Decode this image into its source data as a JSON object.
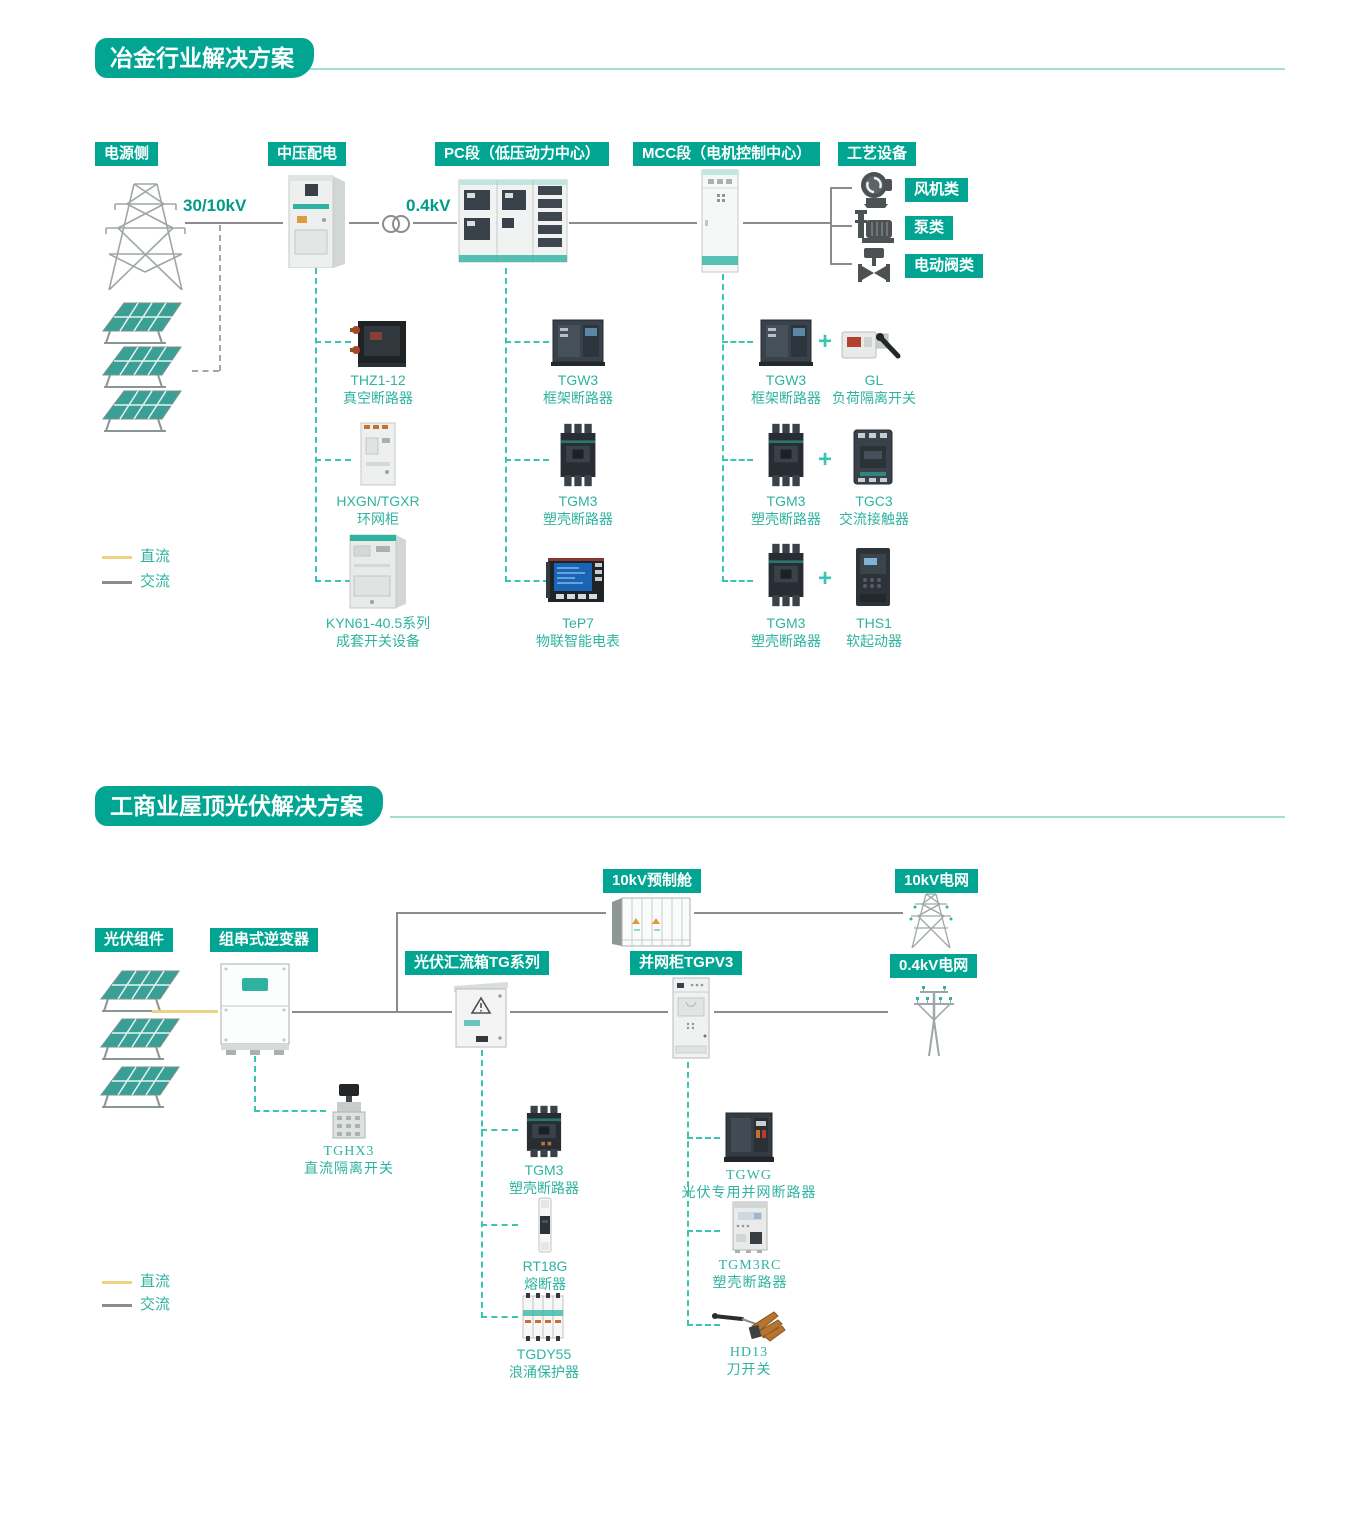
{
  "colors": {
    "teal": "#02a592",
    "teal_dash": "#3cc4b2",
    "label_teal": "#2fb3a0",
    "line_gray": "#8c8c8c",
    "dc_yellow": "#f0d285",
    "rule_teal": "#a5ded5"
  },
  "s1": {
    "title": "冶金行业解决方案",
    "tags": {
      "source": "电源侧",
      "mv": "中压配电",
      "pc": "PC段（低压动力中心）",
      "mcc": "MCC段（电机控制中心）",
      "process": "工艺设备"
    },
    "volt_hv": "30/10kV",
    "volt_lv": "0.4kV",
    "loads": [
      {
        "label": "风机类"
      },
      {
        "label": "泵类"
      },
      {
        "label": "电动阀类"
      }
    ],
    "plus": "+",
    "mv_products": [
      {
        "name": "THZ1-12",
        "desc": "真空断路器"
      },
      {
        "name": "HXGN/TGXR",
        "desc": "环网柜"
      },
      {
        "name": "KYN61-40.5系列",
        "desc": "成套开关设备"
      }
    ],
    "pc_products": [
      {
        "name": "TGW3",
        "desc": "框架断路器"
      },
      {
        "name": "TGM3",
        "desc": "塑壳断路器"
      },
      {
        "name": "TeP7",
        "desc": "物联智能电表"
      }
    ],
    "mcc_products": [
      {
        "a_name": "TGW3",
        "a_desc": "框架断路器",
        "b_name": "GL",
        "b_desc": "负荷隔离开关"
      },
      {
        "a_name": "TGM3",
        "a_desc": "塑壳断路器",
        "b_name": "TGC3",
        "b_desc": "交流接触器"
      },
      {
        "a_name": "TGM3",
        "a_desc": "塑壳断路器",
        "b_name": "THS1",
        "b_desc": "软起动器"
      }
    ],
    "legend": {
      "dc": "直流",
      "ac": "交流"
    }
  },
  "s2": {
    "title": "工商业屋顶光伏解决方案",
    "tags": {
      "pv": "光伏组件",
      "inverter": "组串式逆变器",
      "combiner": "光伏汇流箱TG系列",
      "grid_cab": "并网柜TGPV3",
      "cabin": "10kV预制舱",
      "grid10": "10kV电网",
      "grid04": "0.4kV电网"
    },
    "inverter_products": [
      {
        "name": "TGHX3",
        "desc": "直流隔离开关"
      }
    ],
    "combiner_products": [
      {
        "name": "TGM3",
        "desc": "塑壳断路器"
      },
      {
        "name": "RT18G",
        "desc": "熔断器"
      },
      {
        "name": "TGDY55",
        "desc": "浪涌保护器"
      }
    ],
    "grid_products": [
      {
        "name": "TGWG",
        "desc": "光伏专用并网断路器"
      },
      {
        "name": "TGM3RC",
        "desc": "塑壳断路器"
      },
      {
        "name": "HD13",
        "desc": "刀开关"
      }
    ],
    "legend": {
      "dc": "直流",
      "ac": "交流"
    }
  }
}
